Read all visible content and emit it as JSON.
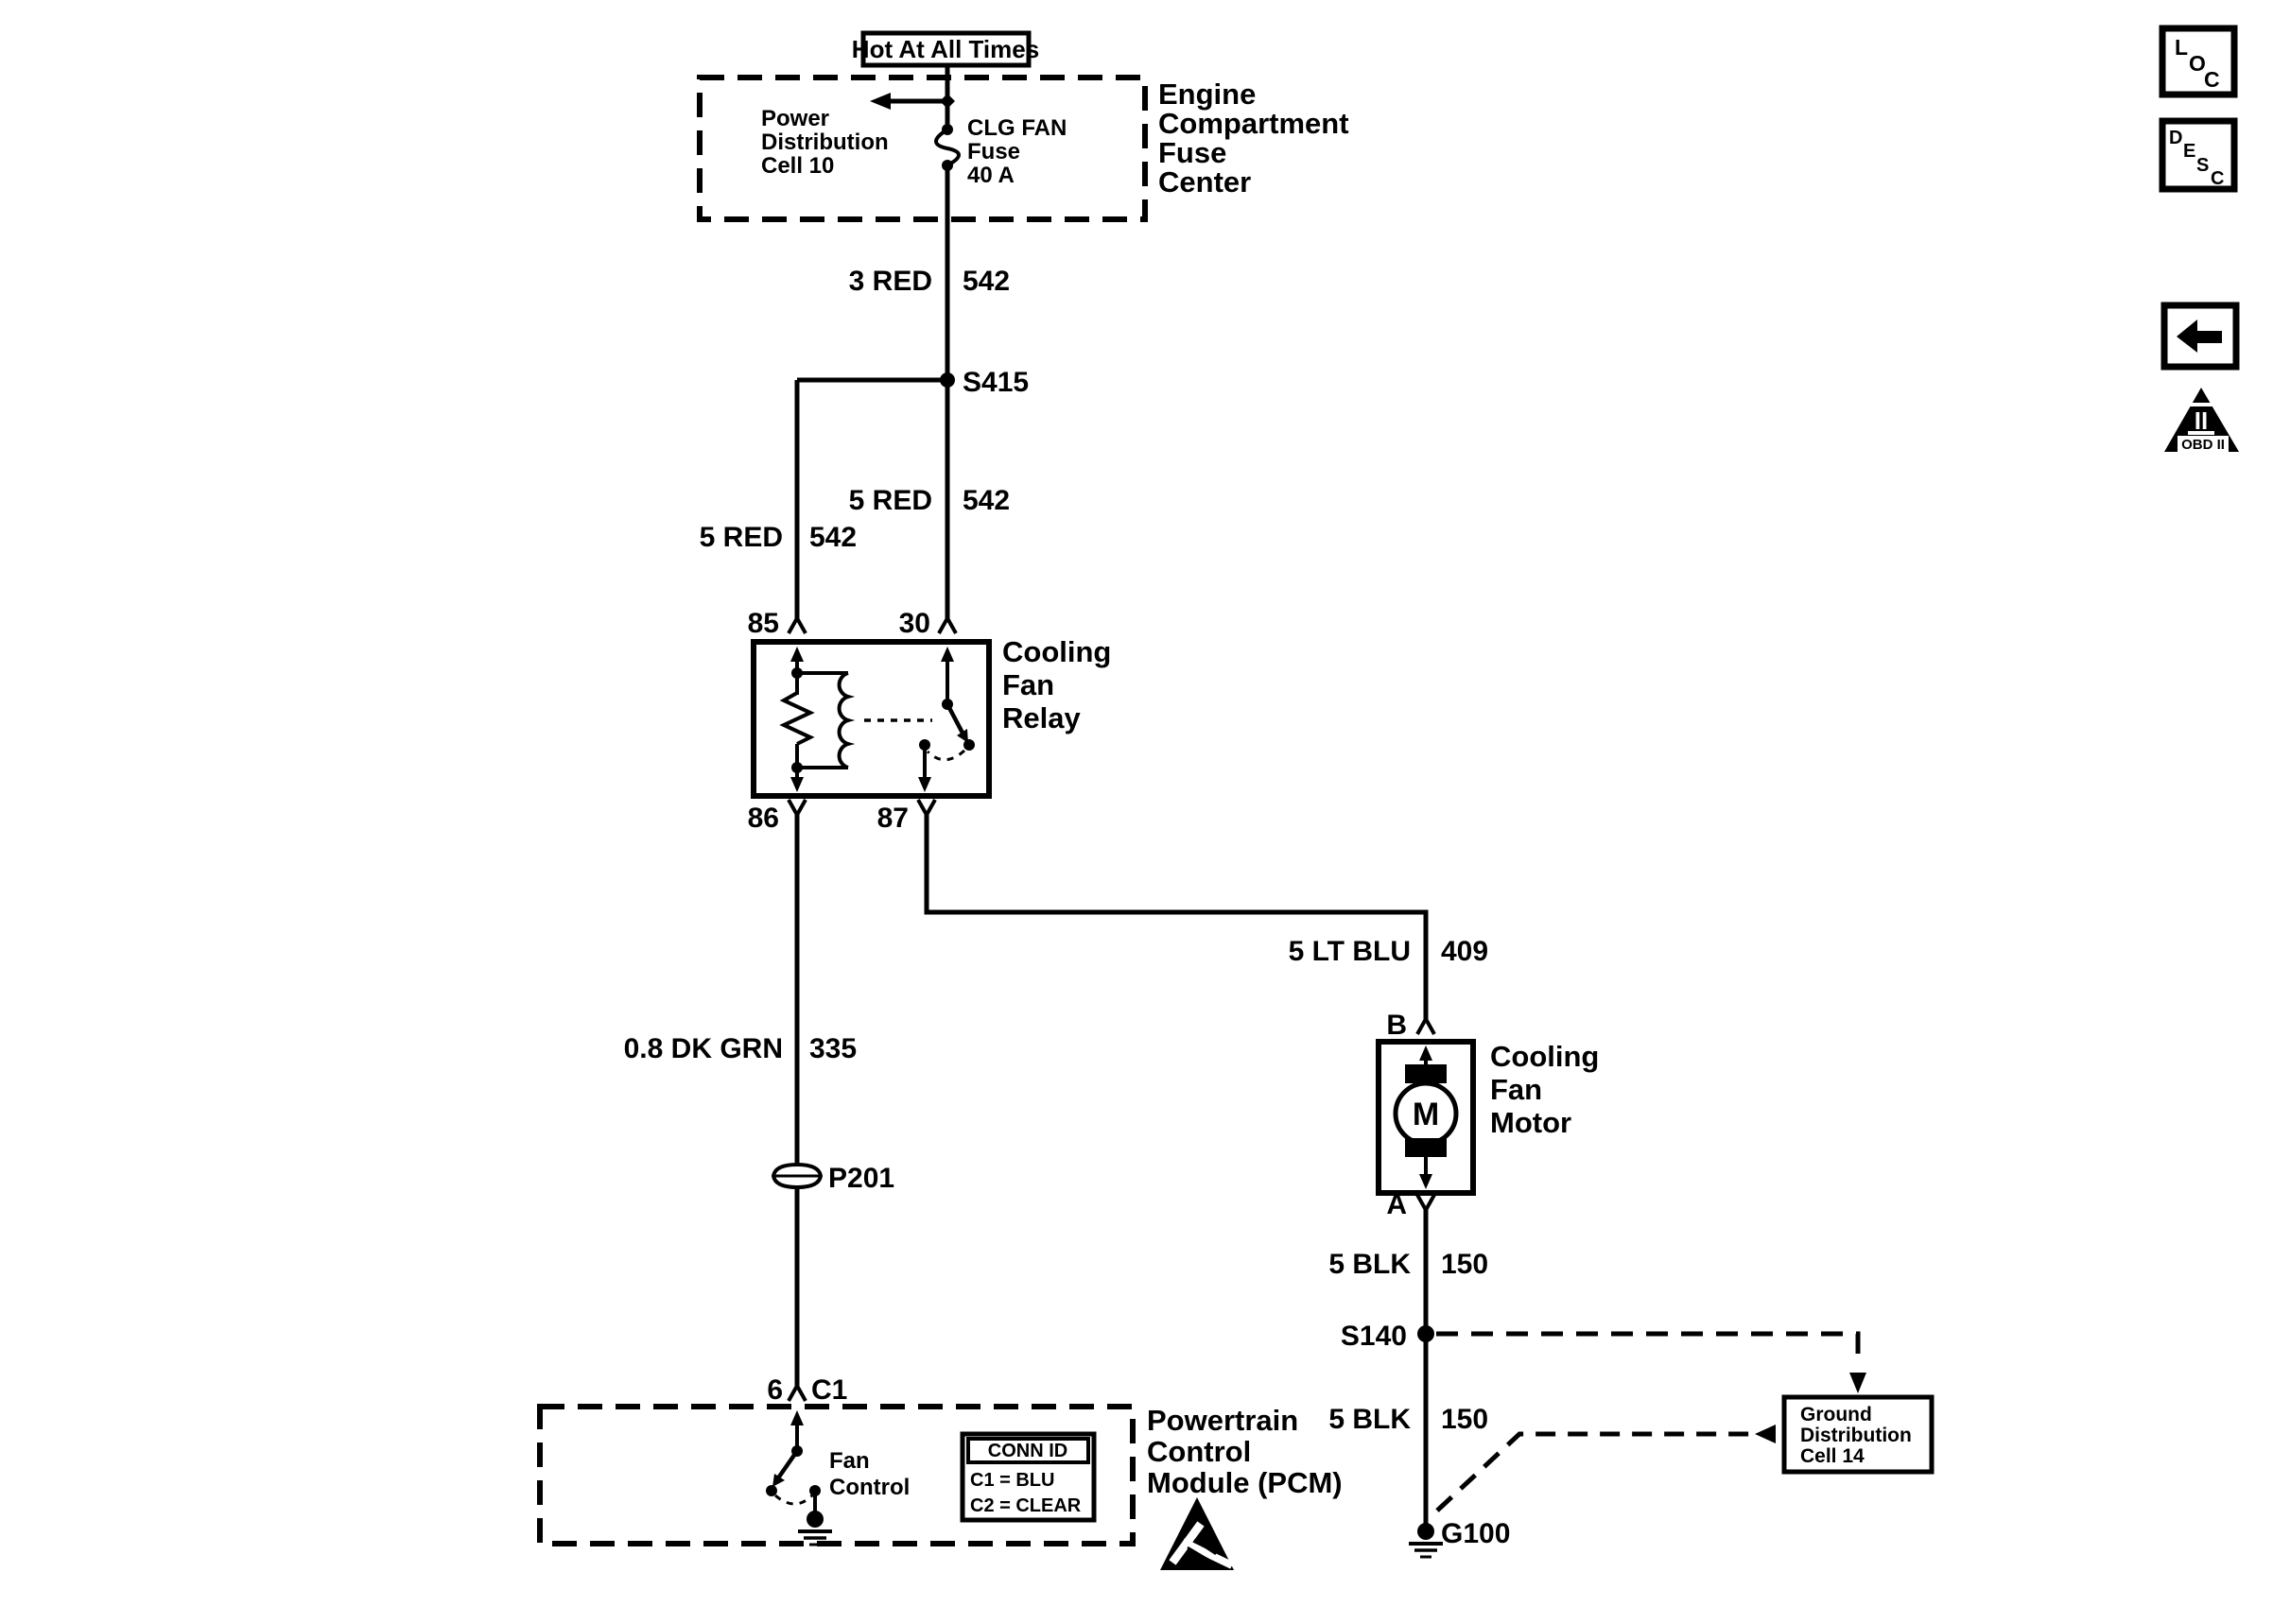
{
  "toolbar": {
    "loc_letters": [
      "L",
      "O",
      "C"
    ],
    "desc_letters": [
      "D",
      "E",
      "S",
      "C"
    ],
    "obd": {
      "numeral": "II",
      "label": "OBD II"
    }
  },
  "fuse_center": {
    "hot_label": "Hot At All Times",
    "title": [
      "Engine",
      "Compartment",
      "Fuse",
      "Center"
    ],
    "power_dist": [
      "Power",
      "Distribution",
      "Cell 10"
    ],
    "fuse": [
      "CLG FAN",
      "Fuse",
      "40 A"
    ]
  },
  "wires": {
    "red3": {
      "name": "3 RED",
      "circuit": "542"
    },
    "red5_left": {
      "name": "5 RED",
      "circuit": "542"
    },
    "red5_right": {
      "name": "5 RED",
      "circuit": "542"
    },
    "ltblu": {
      "name": "5 LT BLU",
      "circuit": "409"
    },
    "dkgrn": {
      "name": "0.8 DK GRN",
      "circuit": "335"
    },
    "blk_upper": {
      "name": "5 BLK",
      "circuit": "150"
    },
    "blk_lower": {
      "name": "5 BLK",
      "circuit": "150"
    }
  },
  "splices": {
    "s415": "S415",
    "s140": "S140"
  },
  "ground": {
    "g100": "G100"
  },
  "inline_connector": {
    "p201": "P201"
  },
  "relay": {
    "title": [
      "Cooling",
      "Fan",
      "Relay"
    ],
    "pin85": "85",
    "pin30": "30",
    "pin86": "86",
    "pin87": "87"
  },
  "motor": {
    "title": [
      "Cooling",
      "Fan",
      "Motor"
    ],
    "pin_b": "B",
    "pin_a": "A",
    "symbol": "M"
  },
  "pcm": {
    "title": [
      "Powertrain",
      "Control",
      "Module (PCM)"
    ],
    "pin_number": "6",
    "pin_connector": "C1",
    "switch_label": [
      "Fan",
      "Control"
    ],
    "conn_table": {
      "header": "CONN ID",
      "row1": "C1 = BLU",
      "row2": "C2 = CLEAR"
    }
  },
  "ground_dist": {
    "title": [
      "Ground",
      "Distribution",
      "Cell 14"
    ]
  },
  "colors": {
    "ink": "#000000",
    "paper": "#ffffff"
  }
}
